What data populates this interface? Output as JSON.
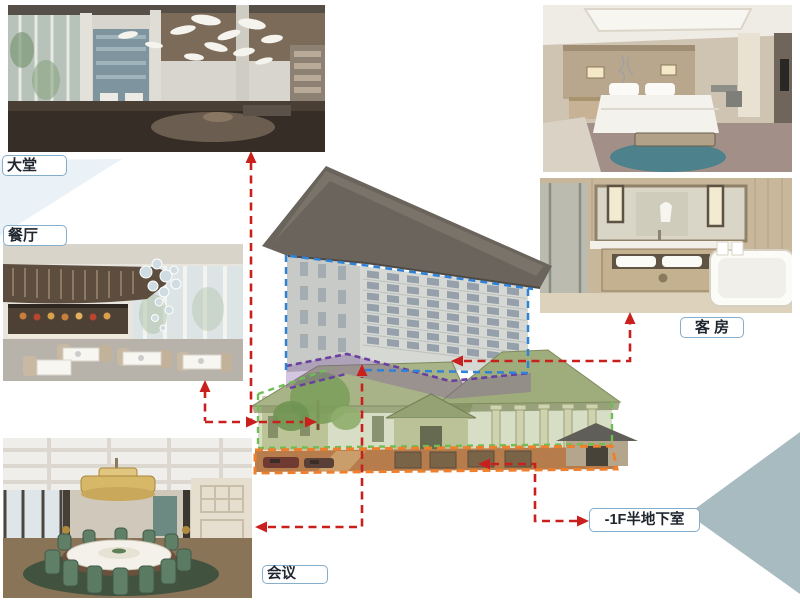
{
  "slide": {
    "labels": {
      "lobby": "大堂",
      "restaurant": "餐厅",
      "meeting": "会议",
      "guest_room": "客 房",
      "basement": "-1F半地下室"
    },
    "zone_colors": {
      "guest_room_tower_outline_blue": "#2f82d8",
      "meeting_level_outline_purple": "#6a3fa0",
      "podium_level_outline_green": "#6fbe54",
      "basement_level_outline_orange": "#ee7f2d",
      "connector_arrow_red": "#c9201d",
      "callout_border_blue": "#85aecd",
      "watermark_teal": "#a8bbc1"
    }
  }
}
